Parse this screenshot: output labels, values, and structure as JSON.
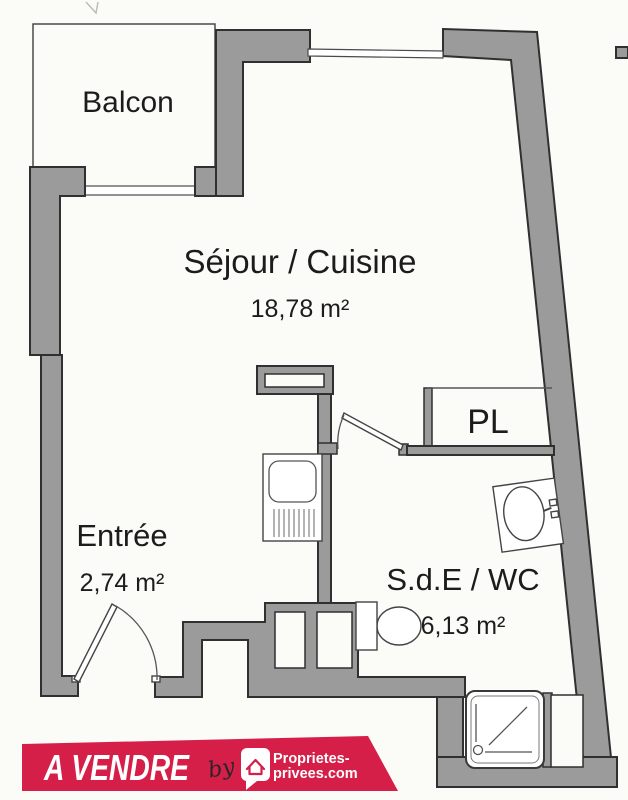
{
  "rooms": {
    "balcony": {
      "label": "Balcon"
    },
    "living": {
      "label": "Séjour / Cuisine",
      "area": "18,78 m²"
    },
    "closet": {
      "label": "PL"
    },
    "entrance": {
      "label": "Entrée",
      "area": "2,74 m²"
    },
    "bathroom": {
      "label": "S.d.E / WC",
      "area": "6,13 m²"
    }
  },
  "banner": {
    "status": "A VENDRE",
    "connector": "by",
    "brand_line1": "Proprietes-",
    "brand_line2": "privees.com"
  },
  "fixtures": [
    "kitchen-sink",
    "washbasin",
    "toilet",
    "shower-tray",
    "entrance-door",
    "bathroom-door"
  ],
  "colors": {
    "wall_fill": "#9b9b9b",
    "wall_stroke": "#303030",
    "banner_red": "#d51f48",
    "background": "#fbfbf8",
    "label_text": "#1c1c1c"
  }
}
